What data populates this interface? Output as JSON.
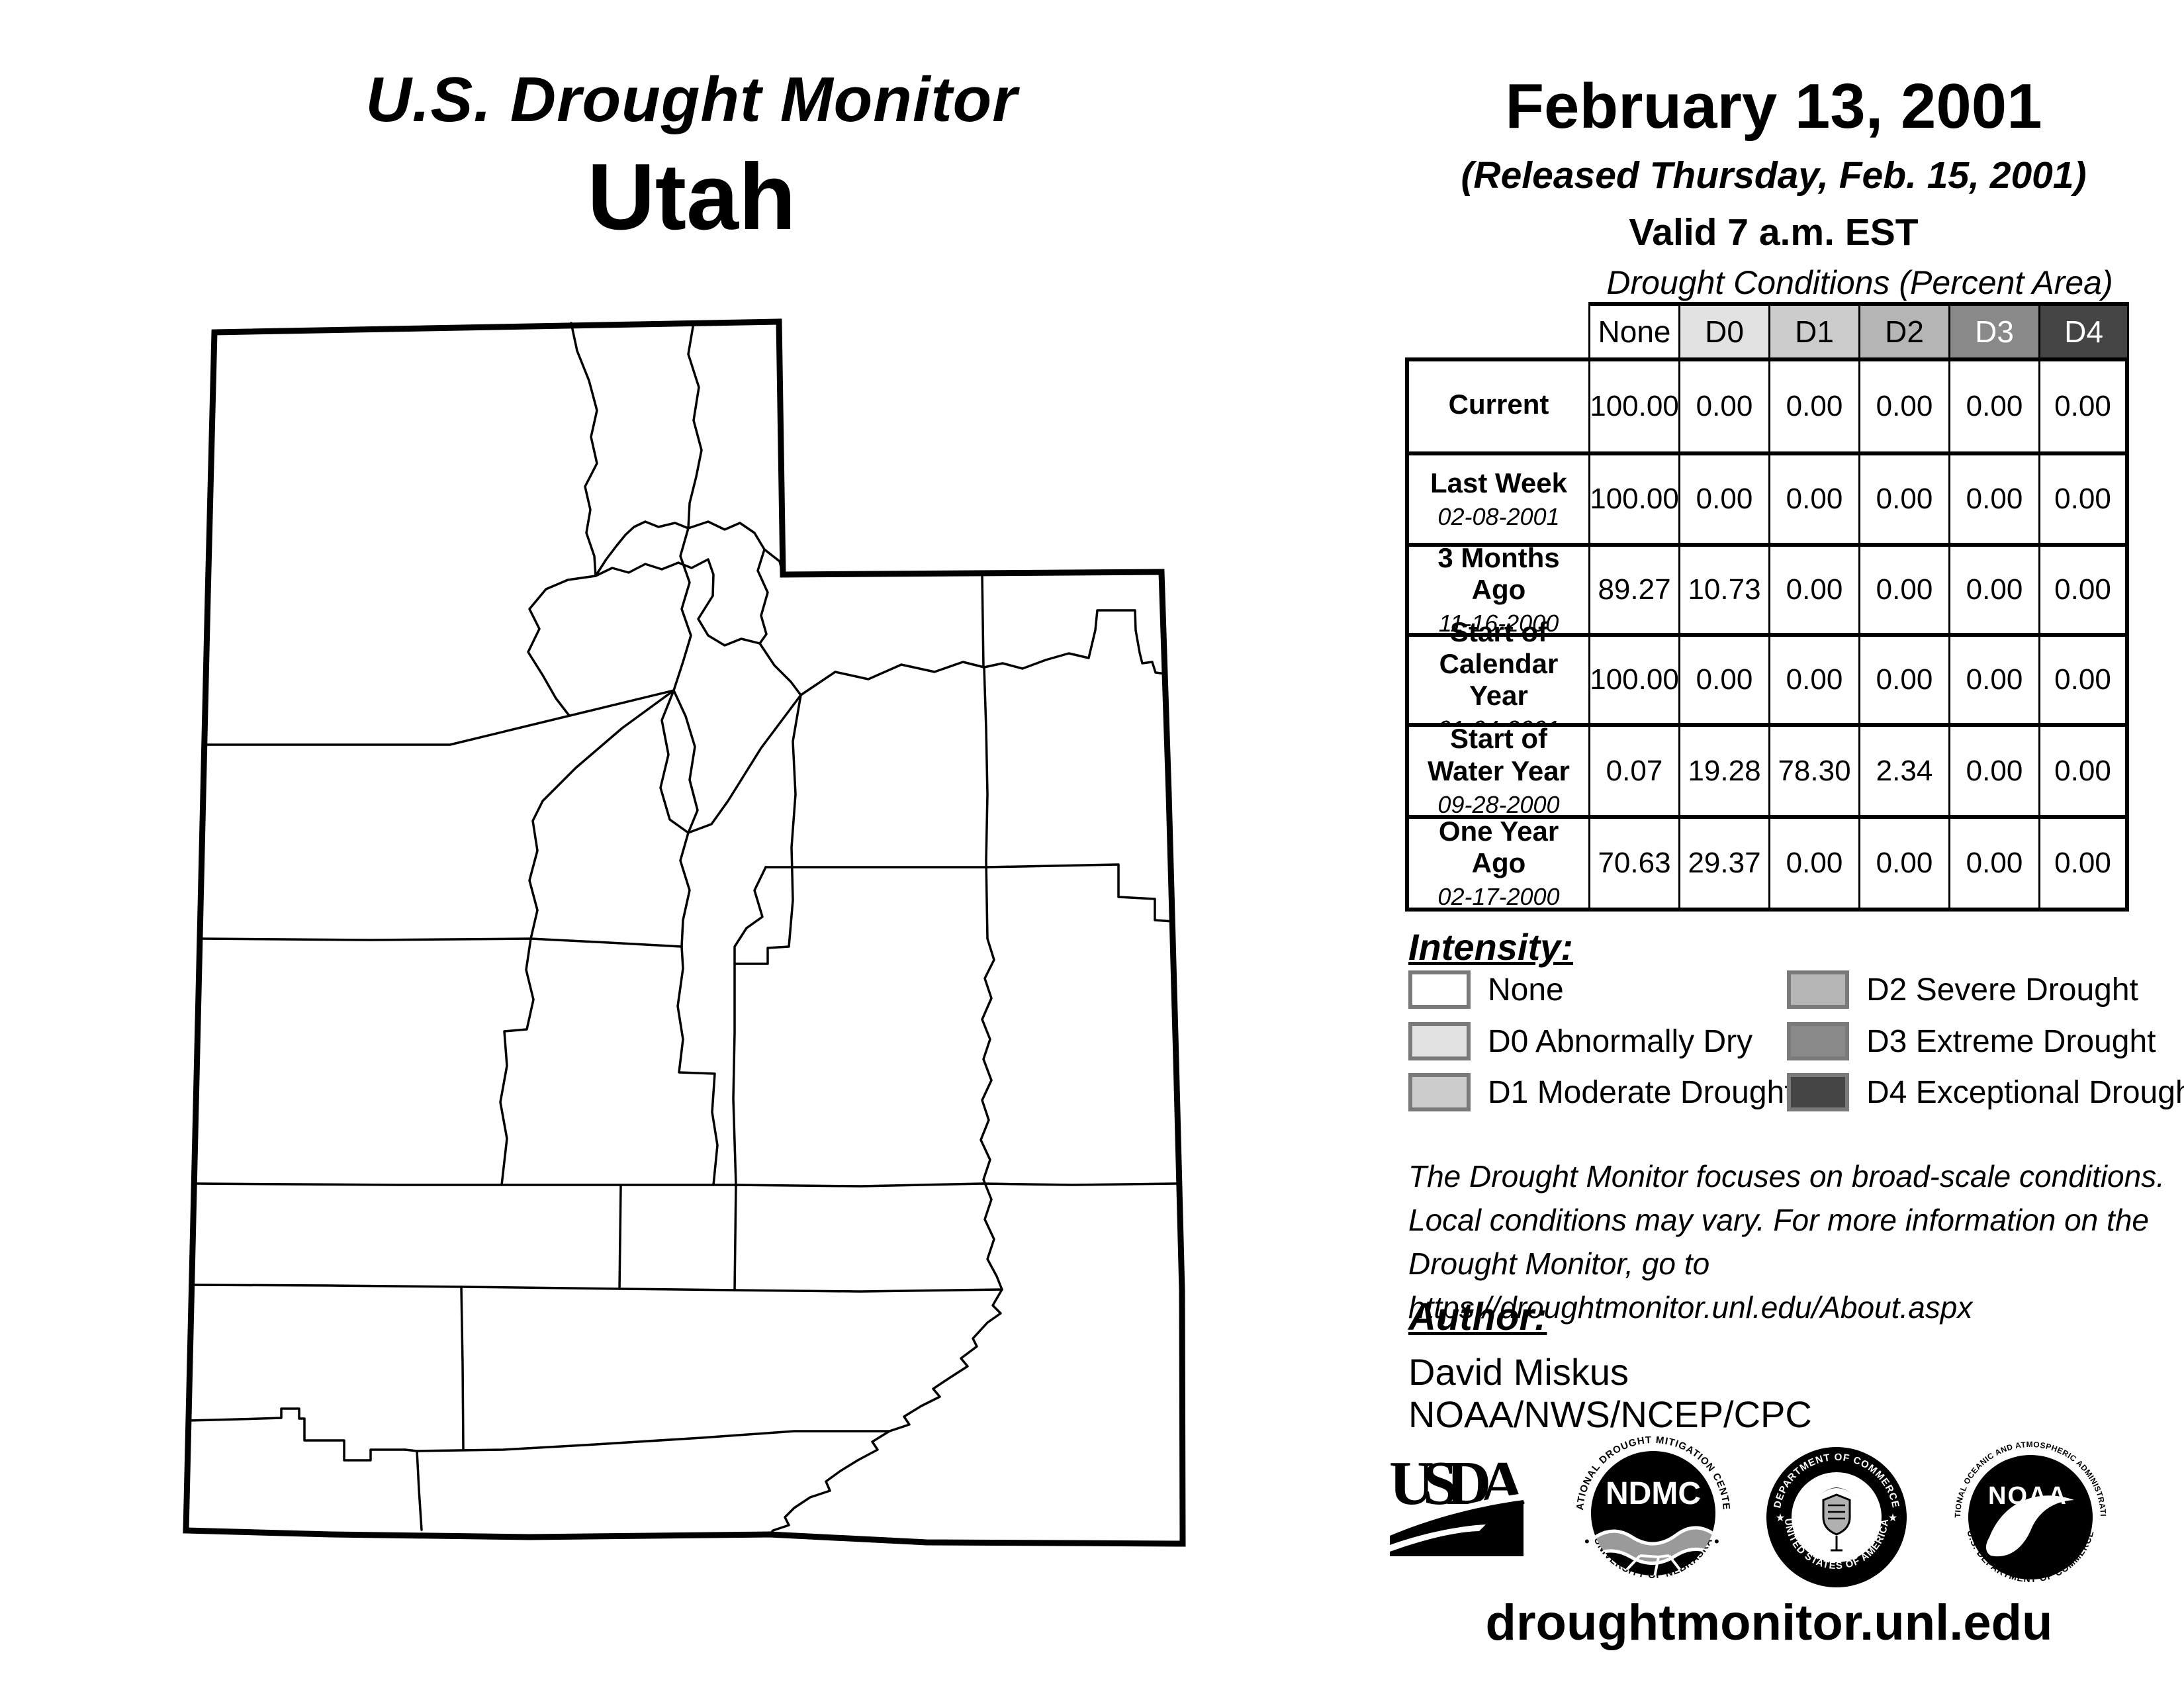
{
  "title_block": {
    "title": "U.S. Drought Monitor",
    "state": "Utah"
  },
  "date_block": {
    "date": "February 13, 2001",
    "released": "(Released Thursday, Feb. 15, 2001)",
    "valid": "Valid 7 a.m. EST"
  },
  "conditions_table": {
    "title": "Drought Conditions (Percent Area)",
    "columns": [
      "None",
      "D0",
      "D1",
      "D2",
      "D3",
      "D4"
    ],
    "column_colors": [
      "#ffffff",
      "#e2e2e2",
      "#cccccc",
      "#b5b5b5",
      "#898989",
      "#454545"
    ],
    "rows": [
      {
        "label": "Current",
        "date": "",
        "values": [
          "100.00",
          "0.00",
          "0.00",
          "0.00",
          "0.00",
          "0.00"
        ]
      },
      {
        "label": "Last Week",
        "date": "02-08-2001",
        "values": [
          "100.00",
          "0.00",
          "0.00",
          "0.00",
          "0.00",
          "0.00"
        ]
      },
      {
        "label": "3 Months Ago",
        "date": "11-16-2000",
        "values": [
          "89.27",
          "10.73",
          "0.00",
          "0.00",
          "0.00",
          "0.00"
        ]
      },
      {
        "label": "Start of Calendar Year",
        "date": "01-04-2001",
        "values": [
          "100.00",
          "0.00",
          "0.00",
          "0.00",
          "0.00",
          "0.00"
        ]
      },
      {
        "label": "Start of Water Year",
        "date": "09-28-2000",
        "values": [
          "0.07",
          "19.28",
          "78.30",
          "2.34",
          "0.00",
          "0.00"
        ]
      },
      {
        "label": "One Year Ago",
        "date": "02-17-2000",
        "values": [
          "70.63",
          "29.37",
          "0.00",
          "0.00",
          "0.00",
          "0.00"
        ]
      }
    ]
  },
  "legend": {
    "heading": "Intensity:",
    "items": [
      {
        "label": "None",
        "color": "#ffffff"
      },
      {
        "label": "D0 Abnormally Dry",
        "color": "#e2e2e2"
      },
      {
        "label": "D1 Moderate Drought",
        "color": "#cccccc"
      },
      {
        "label": "D2 Severe Drought",
        "color": "#b5b5b5"
      },
      {
        "label": "D3 Extreme Drought",
        "color": "#898989"
      },
      {
        "label": "D4 Exceptional Drought",
        "color": "#454545"
      }
    ]
  },
  "disclaimer": {
    "line1": "The Drought Monitor focuses on broad-scale conditions.",
    "line2": "Local conditions may vary. For more information on the",
    "line3": "Drought Monitor, go to https://droughtmonitor.unl.edu/About.aspx"
  },
  "author_block": {
    "heading": "Author:",
    "name": "David Miskus",
    "organization": "NOAA/NWS/NCEP/CPC"
  },
  "logos": {
    "usda_text": "USDA",
    "ndmc_text": "NDMC",
    "ndmc_arc_top": "NATIONAL DROUGHT MITIGATION CENTER",
    "ndmc_arc_bottom": "UNIVERSITY OF NEBRASKA",
    "doc_arc_top": "DEPARTMENT OF COMMERCE",
    "doc_arc_bottom": "UNITED STATES OF AMERICA",
    "noaa_text": "NOAA",
    "noaa_arc_top": "NATIONAL OCEANIC AND ATMOSPHERIC ADMINISTRATION",
    "noaa_arc_bottom": "U.S. DEPARTMENT OF COMMERCE"
  },
  "footer": {
    "url": "droughtmonitor.unl.edu"
  },
  "map": {
    "region": "Utah counties",
    "fill": "#ffffff",
    "line_color": "#000000"
  }
}
